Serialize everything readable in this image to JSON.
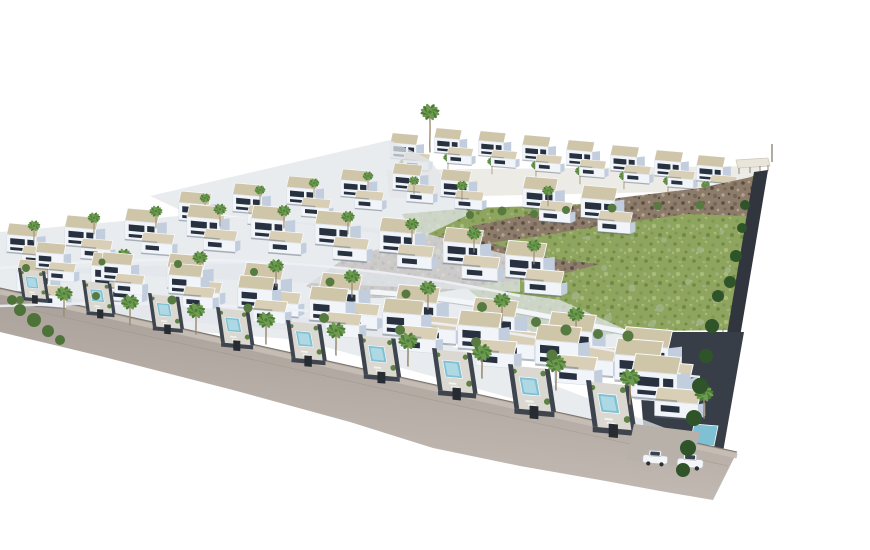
{
  "palette": {
    "bg": "#ffffff",
    "roofTan": "#cfc5a9",
    "roofTan2": "#d8cfb6",
    "wallWhite": "#f1f5f9",
    "wallShade": "#c2cedd",
    "window": "#273140",
    "parapet": "#fafcfe",
    "outline": "#c9d2dc",
    "pool": "#7fc0d2",
    "poolIn": "#aed9e4",
    "paving": "#dbd8d1",
    "paving2": "#b7b1aa",
    "yardWall": "#3f454e",
    "gateDark": "#272c33",
    "bush": "#5d8044",
    "bush2": "#567a40",
    "sage": "#9fb285",
    "ltree": "#4e7338",
    "bshrub": "#2f5429",
    "trunk": "#9b8a70",
    "pf1": "#4e7c38",
    "pf2": "#6d9c50",
    "hillBase": "#8fa45e",
    "hillDot1": "#6d8a43",
    "hillDot2": "#a8bc7c",
    "hillDot3": "#7b9b52",
    "rockBase": "#8d7c6a",
    "rockD1": "#5a4d40",
    "rockD2": "#74665a",
    "rockL": "#b3a38f",
    "road1": "#cdc5bd",
    "road2": "#a59d95",
    "curb": "#7c766f",
    "sidewalk": "#c6bdb4",
    "band": "#383e47",
    "boundary": "#31363e",
    "strip": "#e2e6ea",
    "carBody": "#f3f5f7",
    "glass": "#39424e"
  },
  "scene": {
    "ridge_palms": {
      "name": "palm-tree",
      "symbol": "palm",
      "items": [
        [
          404,
          176,
          0.46
        ],
        [
          448,
          170,
          0.45
        ],
        [
          492,
          174,
          0.45
        ],
        [
          536,
          178,
          0.46
        ],
        [
          580,
          184,
          0.47
        ],
        [
          624,
          189,
          0.47
        ],
        [
          668,
          194,
          0.47
        ],
        [
          706,
          198,
          0.46
        ],
        [
          744,
          200,
          0.44
        ]
      ]
    },
    "tall_palms": {
      "name": "tall-palm-tree",
      "symbol": "palm-tall",
      "items": [
        [
          430,
          152,
          0.8
        ],
        [
          723,
          345,
          0.6
        ]
      ]
    },
    "ridge_villas": {
      "name": "ridge-villa",
      "symbol": "villa",
      "items": [
        [
          388,
          132,
          0.45
        ],
        [
          432,
          127,
          0.44
        ],
        [
          476,
          130,
          0.44
        ],
        [
          520,
          134,
          0.45
        ],
        [
          564,
          139,
          0.45
        ],
        [
          608,
          144,
          0.46
        ],
        [
          652,
          149,
          0.46
        ],
        [
          694,
          154,
          0.46
        ]
      ]
    },
    "upper_villas": {
      "name": "upper-row-villa",
      "symbol": "villa",
      "items": [
        [
          176,
          190,
          0.52
        ],
        [
          230,
          182,
          0.51
        ],
        [
          284,
          175,
          0.5
        ],
        [
          338,
          168,
          0.49
        ],
        [
          390,
          162,
          0.48
        ],
        [
          438,
          168,
          0.49
        ],
        [
          520,
          175,
          0.56
        ],
        [
          578,
          184,
          0.58
        ]
      ]
    },
    "upper_palms": {
      "name": "palm-tree",
      "symbol": "palm",
      "items": [
        [
          205,
          212,
          0.5
        ],
        [
          260,
          204,
          0.5
        ],
        [
          314,
          197,
          0.5
        ],
        [
          368,
          190,
          0.5
        ],
        [
          414,
          194,
          0.48
        ],
        [
          462,
          200,
          0.52
        ],
        [
          548,
          206,
          0.55
        ]
      ]
    },
    "back_villas": {
      "name": "back-row-villa",
      "symbol": "villa",
      "items": [
        [
          4,
          222,
          0.52
        ],
        [
          62,
          214,
          0.54
        ],
        [
          122,
          207,
          0.56
        ],
        [
          184,
          203,
          0.57
        ],
        [
          248,
          204,
          0.59
        ],
        [
          312,
          209,
          0.61
        ],
        [
          376,
          216,
          0.62
        ],
        [
          440,
          226,
          0.64
        ],
        [
          502,
          239,
          0.66
        ]
      ]
    },
    "back_palms": {
      "name": "palm-tree",
      "symbol": "palm",
      "items": [
        [
          34,
          242,
          0.58
        ],
        [
          94,
          234,
          0.58
        ],
        [
          156,
          228,
          0.6
        ],
        [
          220,
          226,
          0.6
        ],
        [
          284,
          228,
          0.62
        ],
        [
          348,
          234,
          0.62
        ],
        [
          412,
          242,
          0.64
        ],
        [
          474,
          252,
          0.66
        ],
        [
          534,
          264,
          0.66
        ]
      ]
    },
    "middle_villas": {
      "name": "middle-row-villa",
      "symbol": "villa",
      "items": [
        [
          14,
          258,
          0.58
        ],
        [
          88,
          251,
          0.6
        ],
        [
          164,
          252,
          0.62
        ],
        [
          240,
          261,
          0.65
        ],
        [
          316,
          271,
          0.68
        ],
        [
          392,
          283,
          0.71
        ],
        [
          468,
          296,
          0.74
        ],
        [
          544,
          310,
          0.77
        ],
        [
          618,
          325,
          0.8
        ]
      ]
    },
    "middle_palms": {
      "name": "palm-tree",
      "symbol": "palm",
      "items": [
        [
          48,
          280,
          0.68
        ],
        [
          124,
          274,
          0.68
        ],
        [
          200,
          277,
          0.7
        ],
        [
          276,
          286,
          0.72
        ],
        [
          352,
          297,
          0.74
        ],
        [
          428,
          309,
          0.76
        ],
        [
          502,
          322,
          0.78
        ],
        [
          576,
          336,
          0.78
        ]
      ]
    },
    "front_units": {
      "name": "front-villa-with-pool",
      "symbol": "front-unit",
      "items": [
        [
          18,
          242,
          0.52
        ],
        [
          82,
          252,
          0.56
        ],
        [
          148,
          263,
          0.6
        ],
        [
          216,
          275,
          0.64
        ],
        [
          286,
          286,
          0.68
        ],
        [
          358,
          298,
          0.72
        ],
        [
          432,
          310,
          0.76
        ],
        [
          508,
          324,
          0.8
        ],
        [
          586,
          338,
          0.84
        ]
      ]
    },
    "corner_villa": {
      "name": "corner-villa",
      "symbol": "villa",
      "items": [
        [
          628,
          352,
          0.78
        ]
      ]
    },
    "front_palms": {
      "name": "palm-tree",
      "symbol": "palm",
      "items": [
        [
          64,
          316,
          0.8
        ],
        [
          130,
          325,
          0.82
        ],
        [
          196,
          334,
          0.84
        ],
        [
          266,
          344,
          0.86
        ],
        [
          336,
          355,
          0.88
        ],
        [
          408,
          366,
          0.9
        ],
        [
          482,
          378,
          0.92
        ],
        [
          556,
          390,
          0.94
        ],
        [
          630,
          404,
          0.94
        ],
        [
          704,
          418,
          0.88
        ]
      ]
    },
    "cars": {
      "name": "parked-car",
      "symbol": "car",
      "items": [
        [
          655,
          462,
          0.95,
          4
        ],
        [
          690,
          466,
          1.0,
          4
        ]
      ]
    },
    "bushes": {
      "name": "garden-shrub",
      "shape": "circle",
      "class": "bush2",
      "items": [
        [
          26,
          268,
          4
        ],
        [
          102,
          262,
          3.5
        ],
        [
          178,
          264,
          4
        ],
        [
          254,
          272,
          4
        ],
        [
          330,
          282,
          4.5
        ],
        [
          406,
          294,
          4.5
        ],
        [
          482,
          307,
          5
        ],
        [
          20,
          300,
          4
        ],
        [
          96,
          296,
          4
        ],
        [
          172,
          300,
          4.5
        ],
        [
          248,
          308,
          4.5
        ],
        [
          324,
          318,
          5
        ],
        [
          400,
          330,
          5
        ],
        [
          476,
          342,
          5
        ],
        [
          552,
          355,
          5.5
        ],
        [
          470,
          215,
          4
        ],
        [
          502,
          211,
          4.5
        ],
        [
          534,
          214,
          4
        ],
        [
          566,
          210,
          4
        ],
        [
          612,
          208,
          4.5
        ],
        [
          658,
          206,
          4
        ],
        [
          700,
          205,
          4.5
        ],
        [
          536,
          322,
          5
        ],
        [
          566,
          330,
          5.5
        ],
        [
          598,
          334,
          5
        ],
        [
          628,
          336,
          5.5
        ]
      ]
    },
    "sage_plants": {
      "name": "hillside-plant",
      "shape": "circle",
      "class": "sage",
      "items": [
        [
          438,
          252,
          3
        ],
        [
          470,
          268,
          4
        ],
        [
          498,
          284,
          3.5
        ],
        [
          452,
          232,
          2.8
        ],
        [
          520,
          256,
          3
        ],
        [
          548,
          276,
          3.5
        ],
        [
          576,
          296,
          4
        ],
        [
          604,
          268,
          3
        ],
        [
          632,
          288,
          3.5
        ],
        [
          660,
          308,
          4
        ],
        [
          688,
          282,
          3
        ],
        [
          700,
          250,
          3.2
        ],
        [
          716,
          300,
          3.5
        ],
        [
          664,
          240,
          2.8
        ],
        [
          608,
          318,
          4
        ],
        [
          652,
          324,
          3.6
        ],
        [
          700,
          322,
          3.4
        ],
        [
          728,
          270,
          3
        ],
        [
          722,
          232,
          2.6
        ],
        [
          588,
          238,
          2.6
        ]
      ]
    },
    "boundary_shrubs": {
      "name": "boundary-shrub",
      "shape": "circle",
      "class": "bshrub",
      "items": [
        [
          718,
          296,
          6
        ],
        [
          712,
          326,
          7
        ],
        [
          706,
          356,
          7
        ],
        [
          700,
          386,
          8
        ],
        [
          694,
          418,
          8
        ],
        [
          688,
          448,
          8
        ],
        [
          683,
          470,
          7
        ],
        [
          745,
          205,
          5
        ],
        [
          742,
          228,
          5
        ],
        [
          736,
          256,
          6
        ],
        [
          730,
          282,
          6
        ]
      ]
    },
    "left_trees": {
      "name": "roadside-tree",
      "shape": "circle",
      "class": "ltree",
      "items": [
        [
          20,
          310,
          6
        ],
        [
          34,
          320,
          7
        ],
        [
          48,
          331,
          6
        ],
        [
          12,
          300,
          5
        ],
        [
          60,
          340,
          5
        ]
      ]
    }
  }
}
